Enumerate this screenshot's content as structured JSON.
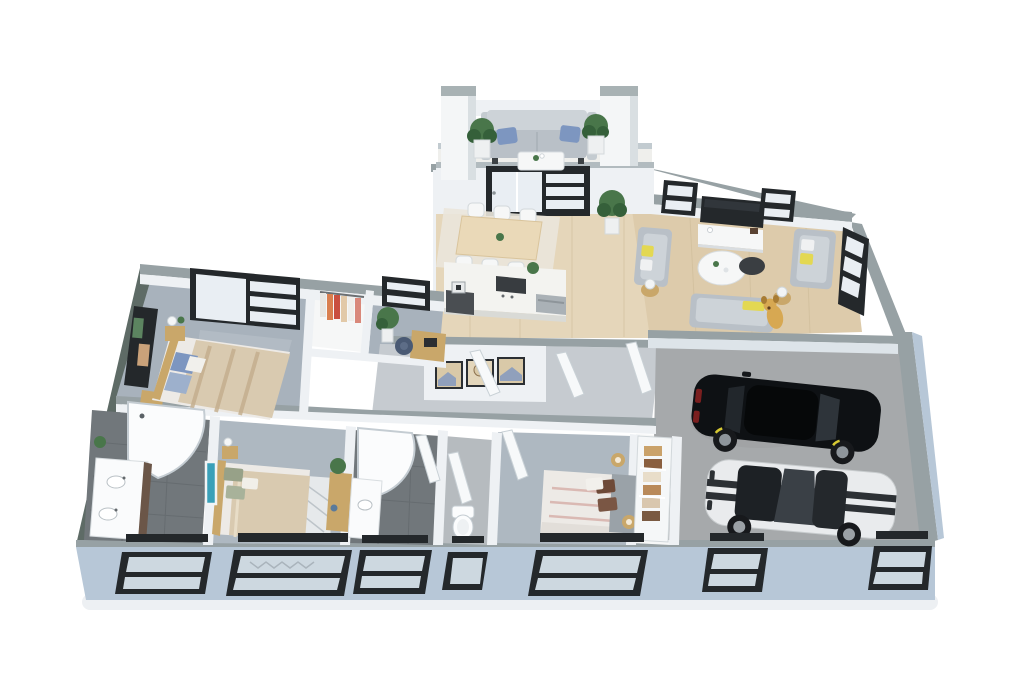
{
  "scene": {
    "description": "3D isometric cutaway floor plan render of a single-story house with attached two-car garage",
    "view": "top-down isometric render",
    "visible_text": "none"
  },
  "palette": {
    "background": "#ffffff",
    "exterior_wall_face": "#b7c7d7",
    "exterior_wall_side": "#5e6b66",
    "wall_top": "#97a1a4",
    "interior_wall": "#eef1f4",
    "interior_wall_top": "#c6ced3",
    "wood_floor": "#ddcbab",
    "wood_floor_light": "#e5d6ba",
    "carpet_master": "#a8b2bc",
    "carpet_bedroom": "#aeb8c1",
    "carpet_hall": "#c6cbd0",
    "tile_dark": "#71777b",
    "tile_light": "#b6bbbf",
    "garage_floor": "#a6a9ab",
    "window_frame": "#24282b",
    "glass": "#e9eef3",
    "glass_reflect": "#cdd8e0",
    "sofa_gray": "#b9c0c7",
    "sofa_light": "#cdd3d8",
    "pillow_blue": "#7d96c0",
    "pillow_yellow": "#e3d852",
    "table_white": "#f6f7f7",
    "wood_furniture": "#c9a76a",
    "bed_blanket": "#d9cab0",
    "bed_white": "#edeae6",
    "plant_green": "#49764a",
    "plant_dark": "#35603a",
    "pot_white": "#eef0f1",
    "island_white": "#f3f3f0",
    "cooktop_dark": "#383c40",
    "steel": "#aab1b6",
    "car_black": "#0e1114",
    "car_white": "#e9ebed",
    "car_stripe": "#2c3034",
    "wheel_dark": "#17191c",
    "dog_gold": "#d7a852"
  },
  "rooms": [
    {
      "id": "entry-porch",
      "label": "entry porch",
      "floor": "white decking",
      "items": [
        "pillar x2",
        "outdoor sofa with 2 blue pillows",
        "white coffee table with flowers",
        "potted plant x2"
      ]
    },
    {
      "id": "kitchen-dining",
      "label": "kitchen and dining",
      "floor": "light oak",
      "items": [
        "dining table",
        "white chairs x6",
        "area rug",
        "kitchen island",
        "cooktop",
        "dishwasher",
        "coffee station",
        "herb plant",
        "entry plant"
      ]
    },
    {
      "id": "living-room",
      "label": "living room",
      "floor": "light oak",
      "items": [
        "wall tv",
        "media console",
        "window x2",
        "side window",
        "sofa x3",
        "yellow pillows",
        "round white coffee table",
        "dark side table",
        "lamp side table x2",
        "golden dog"
      ]
    },
    {
      "id": "master-bedroom",
      "label": "master bedroom",
      "floor": "gray carpet",
      "items": [
        "double bed with striped blanket",
        "blue pillows",
        "wood headboard",
        "nightstand with lamp",
        "wall art panel",
        "dresser",
        "sliding glass door"
      ]
    },
    {
      "id": "walk-in-closet",
      "label": "walk-in closet",
      "floor": "white",
      "items": [
        "hanging clothes rack"
      ]
    },
    {
      "id": "home-office",
      "label": "home office",
      "floor": "gray carpet",
      "items": [
        "desk",
        "office chair",
        "potted plant",
        "window"
      ]
    },
    {
      "id": "master-bathroom",
      "label": "master bathroom",
      "floor": "dark tile",
      "items": [
        "curved glass shower",
        "double vanity with 2 sinks",
        "plant"
      ]
    },
    {
      "id": "bedroom-2",
      "label": "bedroom 2",
      "floor": "gray-blue carpet",
      "items": [
        "double bed",
        "green pillows",
        "patterned rug",
        "nightstand with lamp",
        "teal wall art",
        "desk with plant"
      ]
    },
    {
      "id": "bathroom-2",
      "label": "bathroom 2",
      "floor": "dark tile",
      "items": [
        "curved glass shower",
        "vanity with sink",
        "open door"
      ]
    },
    {
      "id": "wc",
      "label": "toilet room",
      "floor": "gray tile",
      "items": [
        "toilet",
        "open door"
      ]
    },
    {
      "id": "bedroom-3",
      "label": "bedroom 3",
      "floor": "gray carpet",
      "items": [
        "double bed white with pink stripes",
        "brown pillows",
        "gray headboard",
        "wooden ball pendant lamp x2",
        "open door",
        "wardrobe with clothes"
      ]
    },
    {
      "id": "hallway",
      "label": "hallway",
      "floor": "light gray carpet",
      "items": [
        "gallery wall with 3 framed pictures",
        "open white doors x3"
      ]
    },
    {
      "id": "garage",
      "label": "two-car garage",
      "floor": "concrete",
      "items": [
        "black suv",
        "white sports car with black racing stripes",
        "door to hallway"
      ]
    }
  ],
  "vehicles": [
    {
      "id": "black-suv",
      "body_color": "black",
      "detail": "yellow wheel accents, red taillights"
    },
    {
      "id": "white-sports-car",
      "body_color": "white",
      "detail": "twin black racing stripes, black hood scoop and roof"
    }
  ],
  "pets": [
    {
      "id": "dog",
      "type": "golden puppy",
      "location": "living room"
    }
  ],
  "exterior": {
    "front_windows": 7,
    "front_wall_color_name": "light blue-gray siding",
    "gallery_frames": 3
  }
}
